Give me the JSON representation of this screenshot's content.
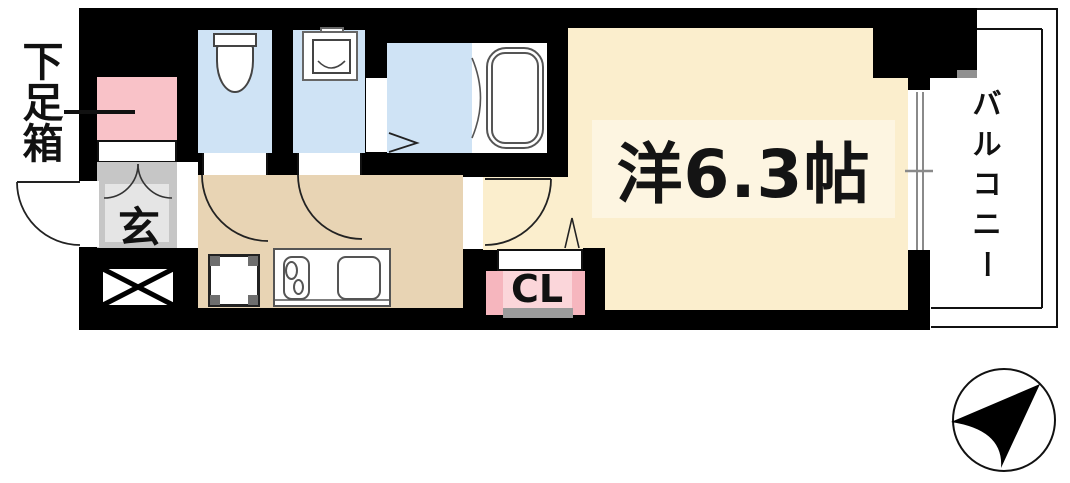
{
  "title": "apartment-floor-plan",
  "labels": {
    "shoe_box": "下足箱",
    "entrance": "玄",
    "main_room": "洋6.3帖",
    "closet": "CL",
    "balcony": "バルコニー"
  },
  "rooms": [
    {
      "name": "shoe-cabinet",
      "label": "下足箱",
      "color": "#f9c2c8"
    },
    {
      "name": "entrance-genkan",
      "label": "玄",
      "color": "#c6c6c6"
    },
    {
      "name": "toilet-room",
      "label": "",
      "color": "#cfe3f5"
    },
    {
      "name": "washer-room",
      "label": "",
      "color": "#cfe3f5"
    },
    {
      "name": "bathroom",
      "label": "",
      "color": "#cfe3f5"
    },
    {
      "name": "kitchen-hallway",
      "label": "",
      "color": "#e8d4b4"
    },
    {
      "name": "main-room",
      "label": "洋6.3帖",
      "color": "#fbeecd"
    },
    {
      "name": "closet",
      "label": "CL",
      "color": "#f6b6be"
    },
    {
      "name": "balcony",
      "label": "バルコニー",
      "color": "#ffffff"
    }
  ],
  "colors": {
    "wall": "#000000",
    "wet_room_floor": "#cfe3f5",
    "hallway_floor": "#e8d4b4",
    "main_room_floor": "#fbeecd",
    "room_label_bg": "#fdf5e1",
    "genkan_outer": "#c6c6c6",
    "genkan_inner": "#e5e5e5",
    "shoebox_pink": "#f9c2c8",
    "closet_pink_outer": "#f6b6be",
    "closet_pink_inner": "#fbd6da",
    "closet_gray_bar": "#9b9b9b"
  },
  "icons": {
    "compass": "north-arrow"
  }
}
